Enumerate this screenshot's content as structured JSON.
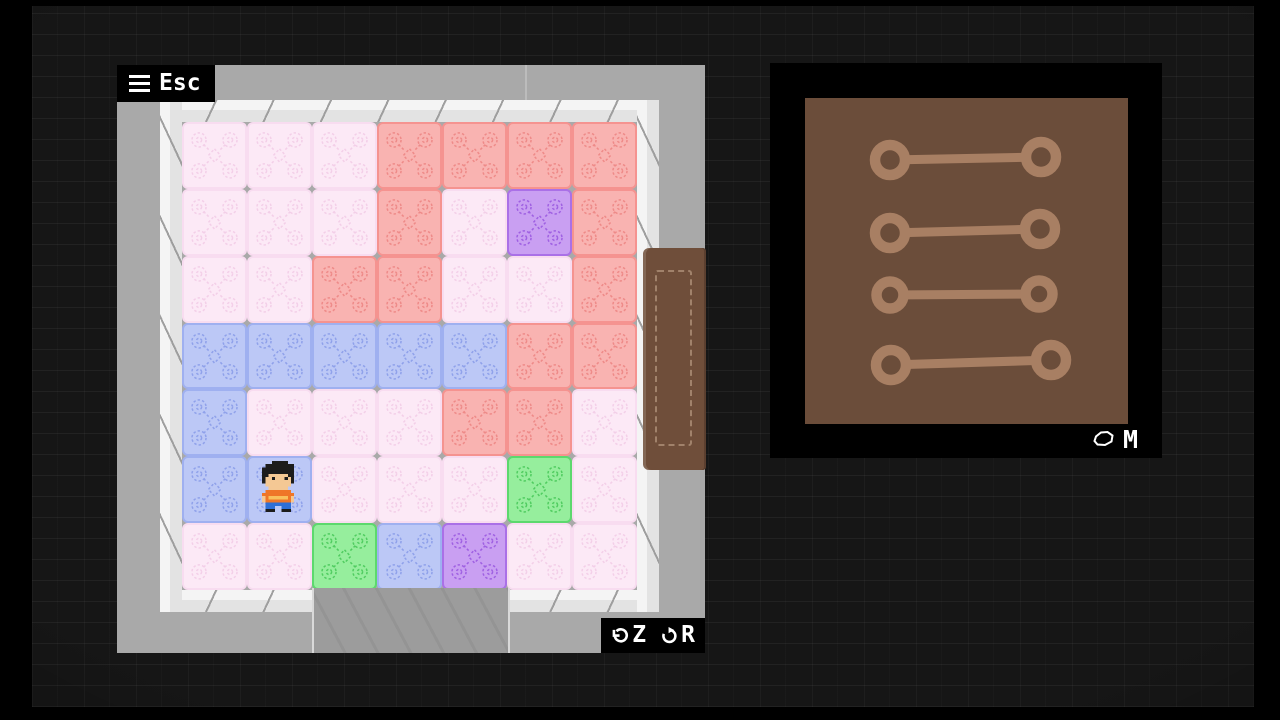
{
  "hud": {
    "menu_label": "Esc",
    "undo_label": "Z",
    "restart_label": "R",
    "map_label": "M",
    "menu_icon": "hamburger-icon",
    "undo_icon": "undo-arrow-icon",
    "restart_icon": "restart-arrow-icon",
    "map_icon": "map-blob-icon"
  },
  "background": {
    "brick_color": "#161616",
    "border_color": "#000000"
  },
  "room": {
    "wall_color": "#a9a9a9",
    "wall_seam_color": "#bcbcbc",
    "trim_color": "#f0f0f0",
    "passage_color": "#9c9c9c",
    "door_color": "#6f4e3a",
    "grid": [
      [
        "pink",
        "pink",
        "pink",
        "red",
        "red",
        "red",
        "red"
      ],
      [
        "pink",
        "pink",
        "pink",
        "red",
        "pink",
        "purple",
        "red"
      ],
      [
        "pink",
        "pink",
        "red",
        "red",
        "pink",
        "pink",
        "red"
      ],
      [
        "blue",
        "blue",
        "blue",
        "blue",
        "blue",
        "red",
        "red"
      ],
      [
        "blue",
        "pink",
        "pink",
        "pink",
        "red",
        "red",
        "pink"
      ],
      [
        "blue",
        "blue",
        "pink",
        "pink",
        "pink",
        "green",
        "pink"
      ],
      [
        "pink",
        "pink",
        "green",
        "blue",
        "purple",
        "pink",
        "pink"
      ]
    ],
    "tile_styles": {
      "pink": {
        "fill": "#fce9f6",
        "border": "#f8dcf0",
        "pattern": "#f3cfe8"
      },
      "red": {
        "fill": "#f9b3b1",
        "border": "#f59390",
        "pattern": "#ee8a88"
      },
      "blue": {
        "fill": "#bcc8f6",
        "border": "#9fb0f0",
        "pattern": "#8fa1ea"
      },
      "purple": {
        "fill": "#c99ff2",
        "border": "#aa70e7",
        "pattern": "#9f60e2"
      },
      "green": {
        "fill": "#96ee9d",
        "border": "#5cd96d",
        "pattern": "#50cc60"
      }
    },
    "player": {
      "row": 5,
      "col": 1,
      "description": "pixel-art boy, black hair, orange shirt, blue pants"
    }
  },
  "player_sprite": {
    "palette": {
      "H": "#1c1c1c",
      "S": "#f4c894",
      "E": "#1c1c1c",
      "O": "#ef7628",
      "L": "#f9c05c",
      "P": "#2e6fd6",
      "K": "#1c1c1c"
    },
    "rows": [
      "....HHHHH....",
      "..HHHHHHHHH..",
      ".HHHHHHHHHH..",
      ".HHHHHHHHHH..",
      ".HHSSSSSSHH..",
      ".HSSESSSESH..",
      ".HSSSSSSSSH..",
      "..SSSSSSSS...",
      "...SSSSSS....",
      "..OOOOOOOO...",
      ".OOOOOOOOOO..",
      ".SOLLLLLLOS..",
      ".SOOOOOOOOS..",
      "..PPPPPPPP...",
      "..PPP..PPP...",
      "..KKK..KKK..."
    ]
  },
  "map_panel": {
    "frame_color": "#000000",
    "board_color": "#6b4d3a",
    "ink_color": "#a87f63",
    "links": [
      {
        "x1": 85,
        "y1": 62,
        "x2": 236,
        "y2": 59,
        "r": 15
      },
      {
        "x1": 85,
        "y1": 135,
        "x2": 235,
        "y2": 131,
        "r": 15
      },
      {
        "x1": 85,
        "y1": 197,
        "x2": 234,
        "y2": 196,
        "r": 13.5
      },
      {
        "x1": 86,
        "y1": 267,
        "x2": 246,
        "y2": 262,
        "r": 15
      }
    ]
  }
}
